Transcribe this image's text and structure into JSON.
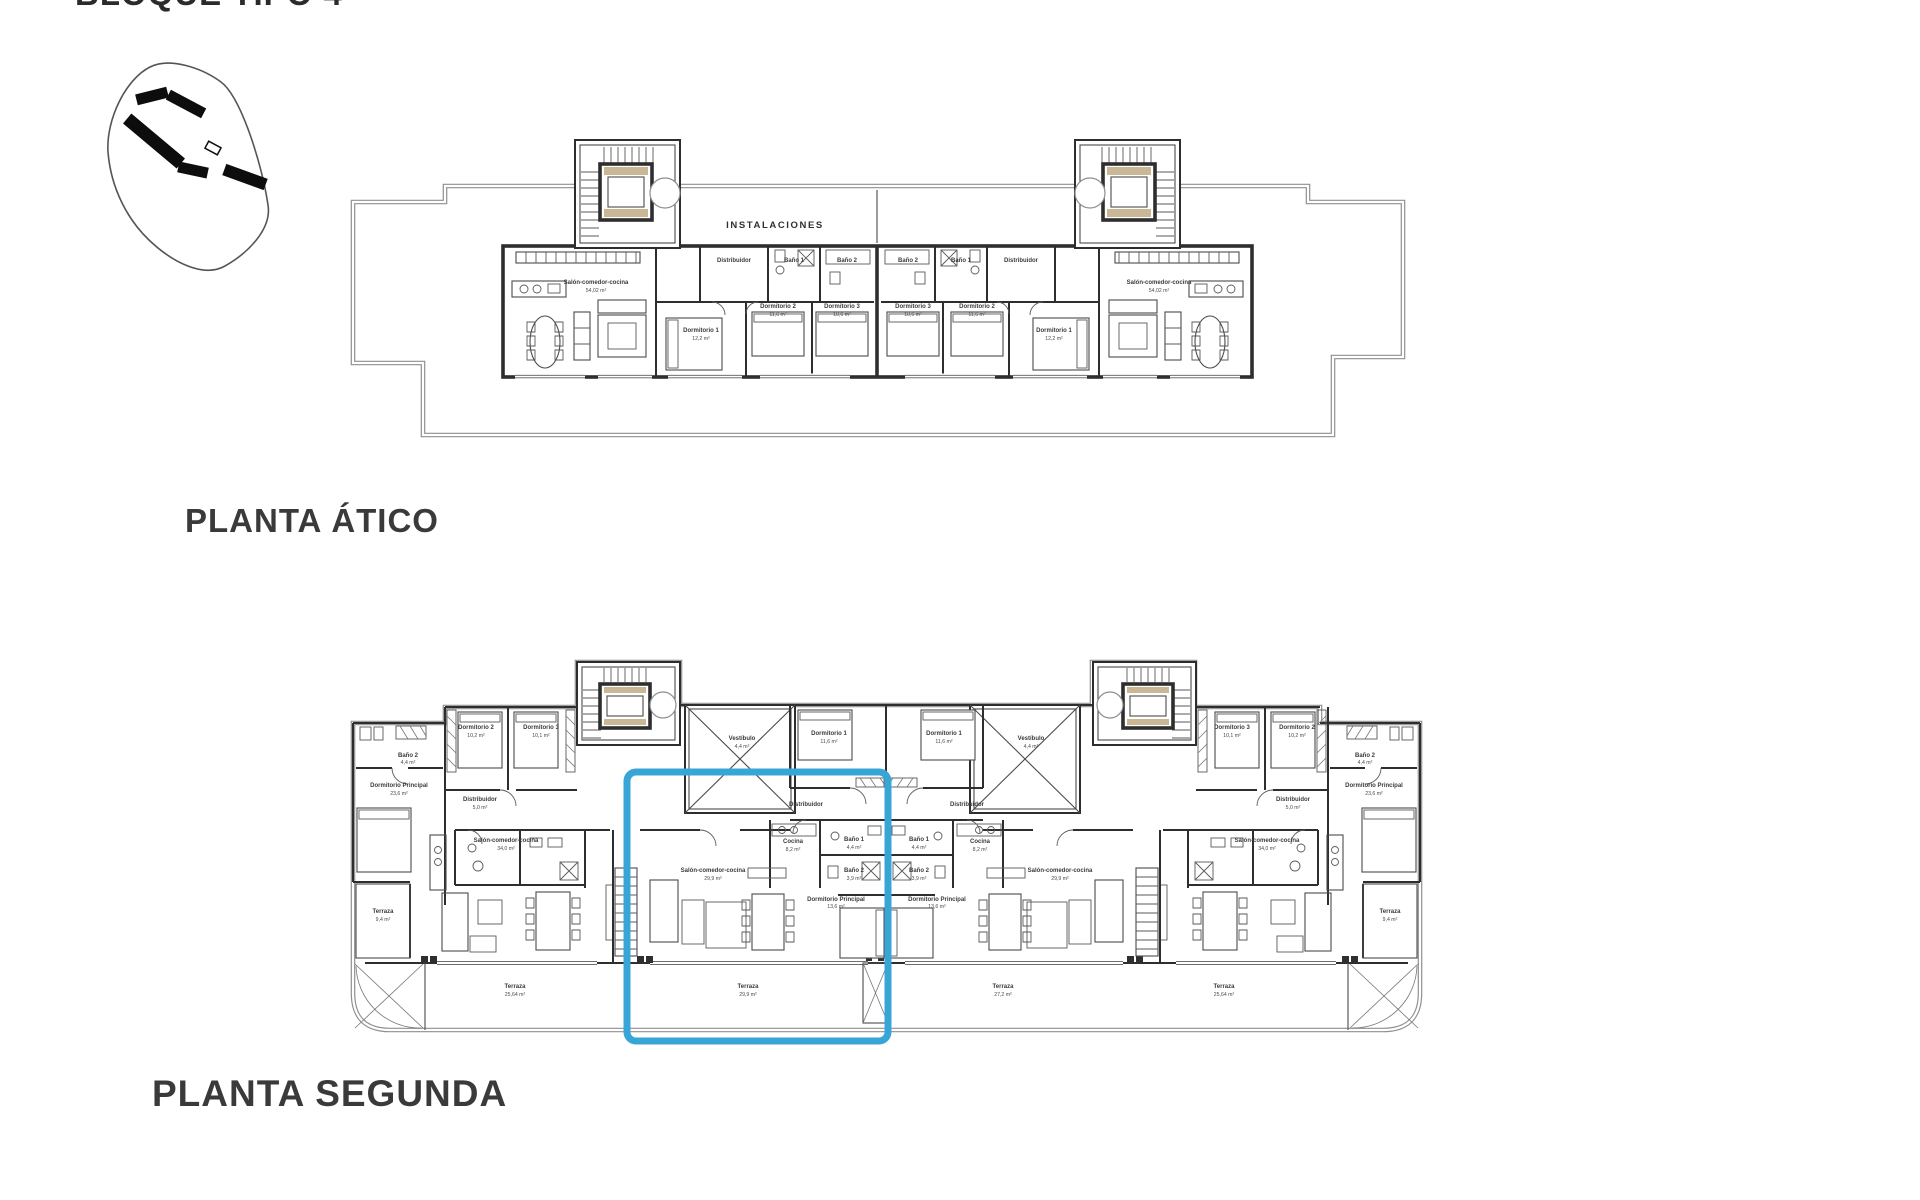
{
  "sheet": {
    "title": "BLOQUE TIPO 4",
    "highlight_color": "#38a5d7",
    "line_color": "#2e2e2e",
    "elevator_accent": "#c9b795"
  },
  "site_map": {
    "description": "site-location-map"
  },
  "plans": {
    "atico": {
      "caption": "PLANTA ÁTICO",
      "roof_label": "INSTALACIONES",
      "rooms": {
        "salon": {
          "name": "Salón-comedor-cocina",
          "area": "54,02 m²"
        },
        "dorm1": {
          "name": "Dormitorio 1",
          "area": "12,2 m²"
        },
        "dorm2": {
          "name": "Dormitorio 2",
          "area": "11,6 m²"
        },
        "dorm3": {
          "name": "Dormitorio 3",
          "area": "10,6 m²"
        },
        "distribuidor": {
          "name": "Distribuidor"
        },
        "bano1": {
          "name": "Baño 1"
        },
        "bano2": {
          "name": "Baño 2"
        }
      }
    },
    "segunda": {
      "caption": "PLANTA SEGUNDA",
      "rooms": {
        "salon_end": {
          "name": "Salón-comedor-cocina",
          "area": "34,0 m²"
        },
        "salon_mid": {
          "name": "Salón-comedor-cocina",
          "area": "29,9 m²"
        },
        "dorm_ppal_end": {
          "name": "Dormitorio Principal",
          "area": "23,6 m²"
        },
        "dorm_ppal_mid": {
          "name": "Dormitorio Principal",
          "area": "13,6 m²"
        },
        "dorm1": {
          "name": "Dormitorio 1",
          "area": "11,6 m²"
        },
        "dorm2": {
          "name": "Dormitorio 2",
          "area": "10,2 m²"
        },
        "dorm3": {
          "name": "Dormitorio 3",
          "area": "10,1 m²"
        },
        "bano1": {
          "name": "Baño 1",
          "area": "4,4 m²"
        },
        "bano2": {
          "name": "Baño 2",
          "area": "3,9 m²"
        },
        "bano2_end": {
          "name": "Baño 2",
          "area": "4,4 m²"
        },
        "cocina": {
          "name": "Cocina",
          "area": "8,2 m²"
        },
        "vestibulo": {
          "name": "Vestíbulo",
          "area": "4,4 m²"
        },
        "distribuidor": {
          "name": "Distribuidor",
          "area": "5,0 m²"
        },
        "terraza_side": {
          "name": "Terraza",
          "area": "9,4 m²"
        },
        "terraza_b1": {
          "name": "Terraza",
          "area": "25,64 m²"
        },
        "terraza_b2": {
          "name": "Terraza",
          "area": "29,9 m²"
        },
        "terraza_b3": {
          "name": "Terraza",
          "area": "27,2 m²"
        },
        "terraza_b4": {
          "name": "Terraza",
          "area": "25,64 m²"
        }
      }
    }
  }
}
